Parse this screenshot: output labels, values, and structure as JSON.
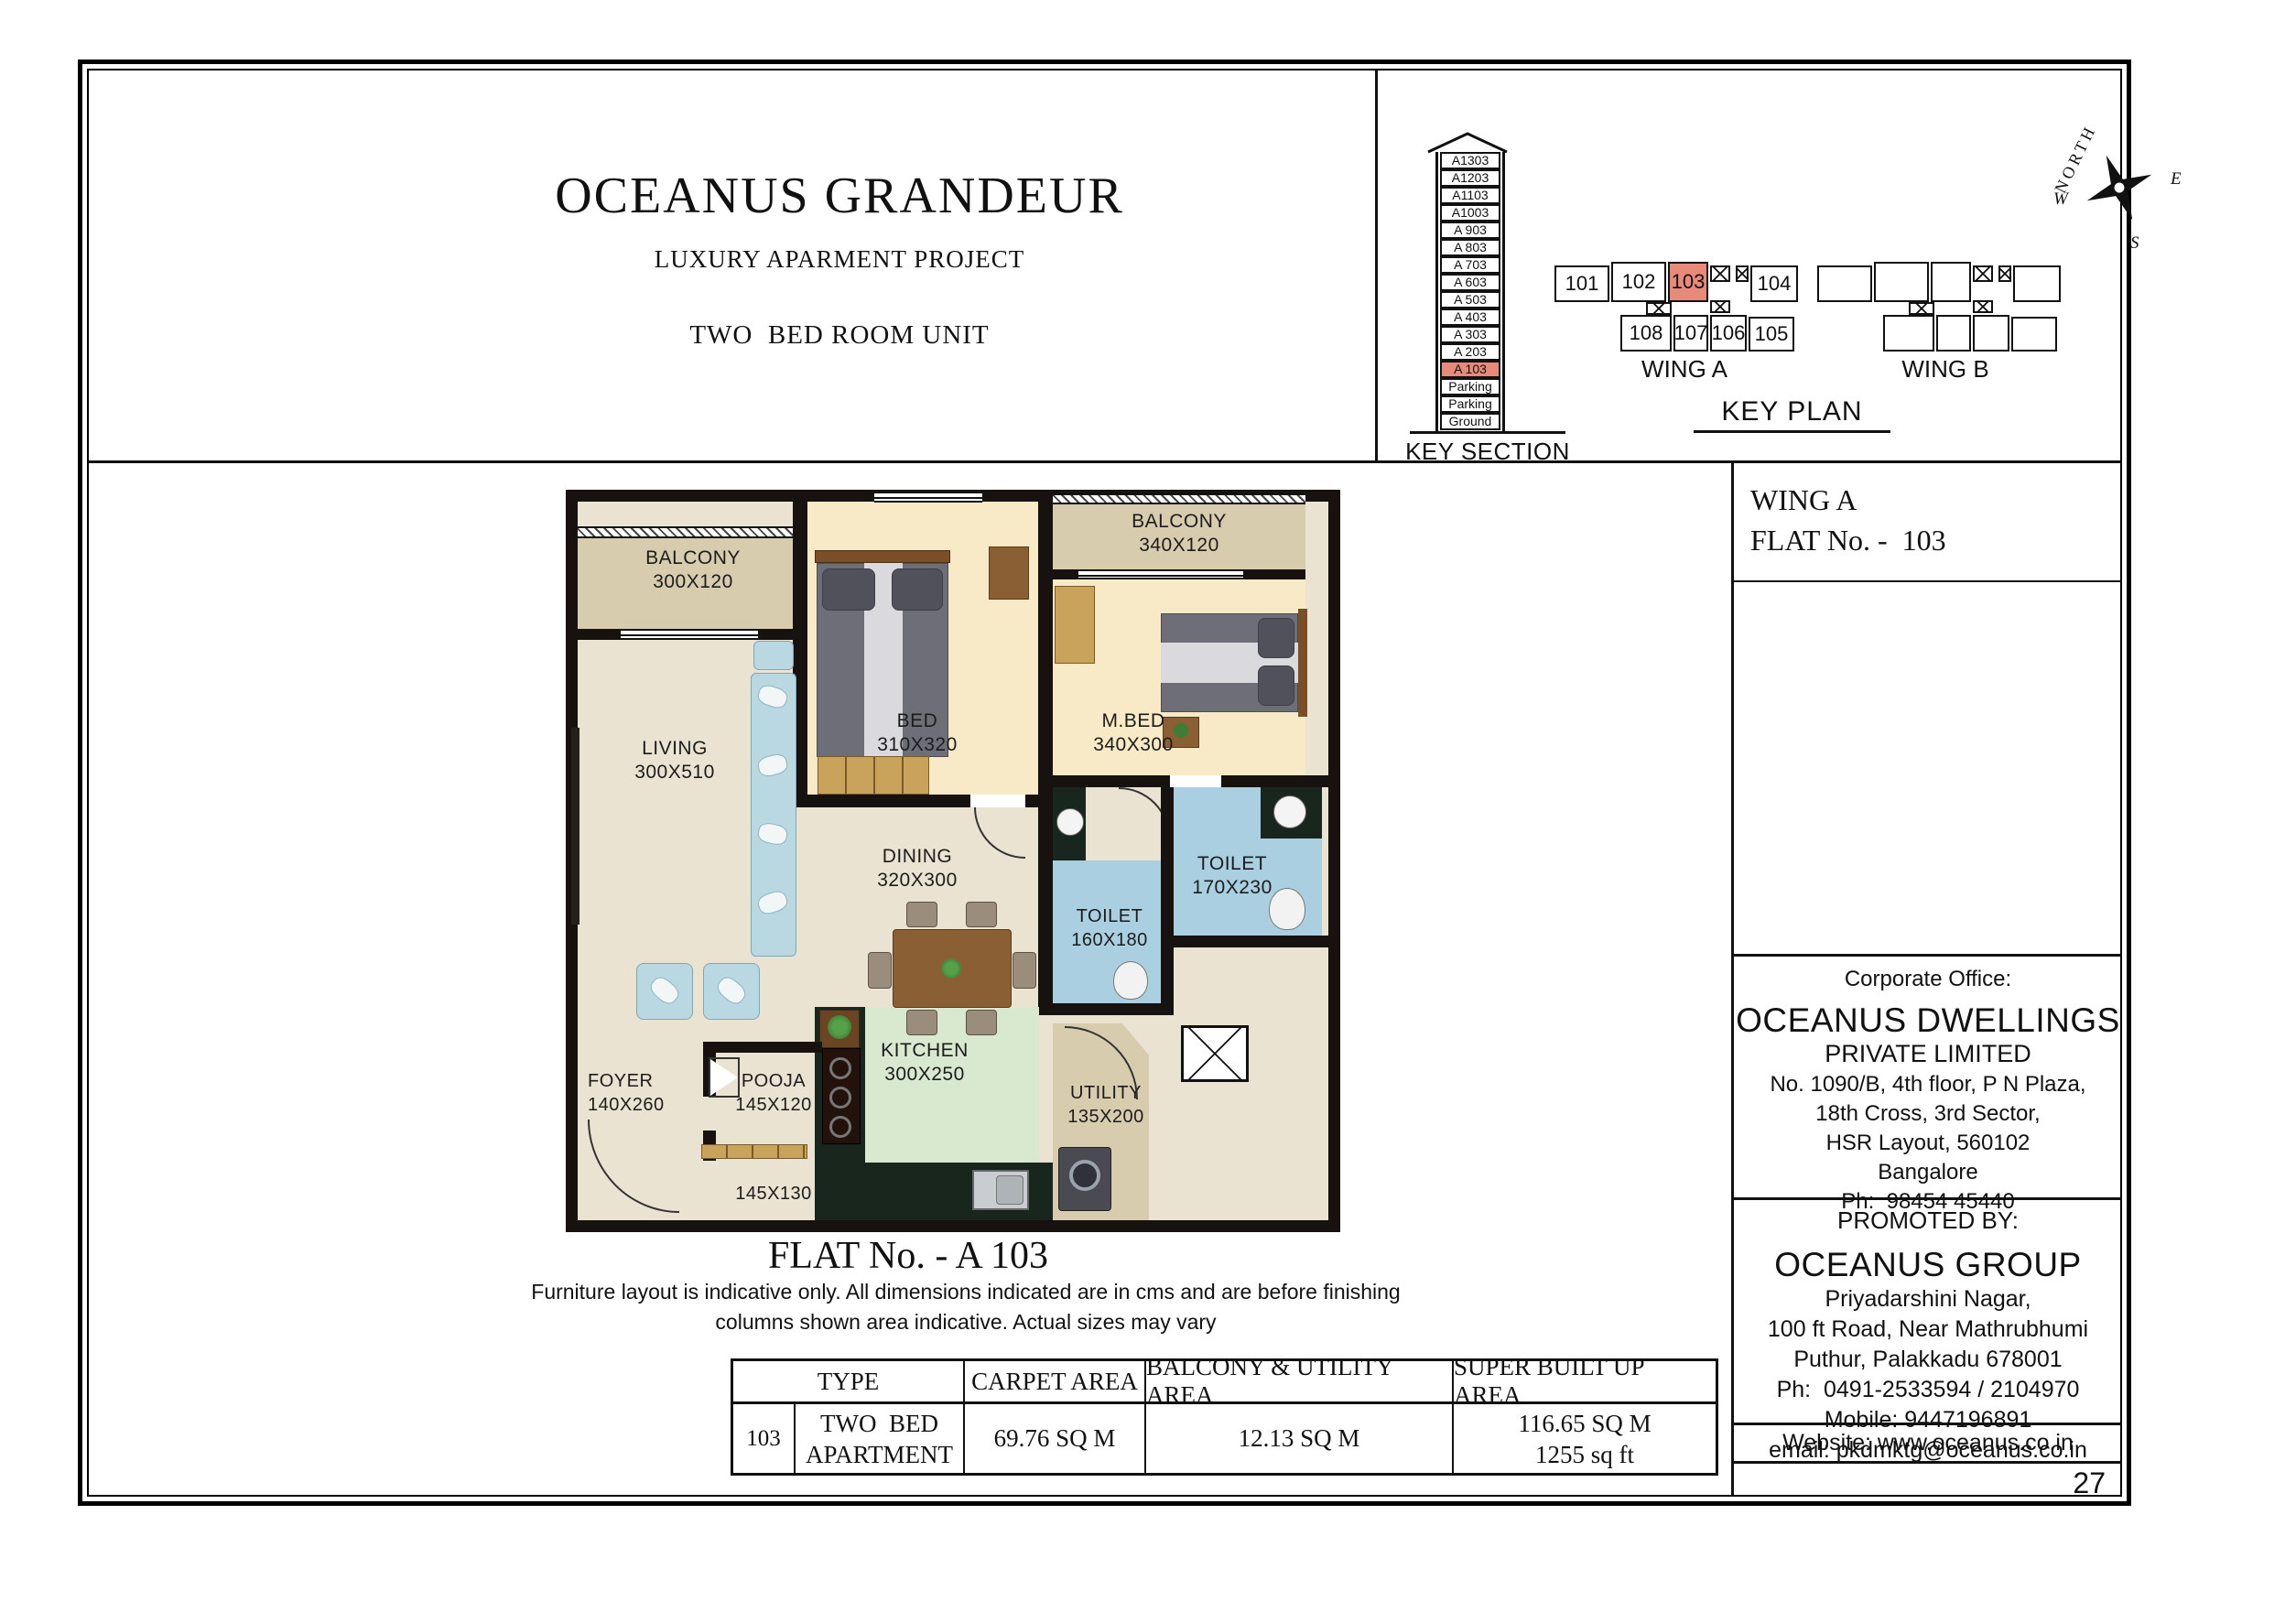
{
  "colors": {
    "highlight": "#e8897a",
    "toilet_blue": "#a9cfe0",
    "kitchen_green": "#d9e9cf",
    "balcony_beige": "#d8ccae",
    "bedroom_cream": "#f8eac6",
    "floor_cream": "#ebe3d1",
    "counter_dark": "#18261e",
    "wood": "#c9a25b",
    "wall": "#17120f",
    "sofa_blue": "#b9d8e1",
    "bed_gray": "#6e6e78"
  },
  "header": {
    "title": "OCEANUS GRANDEUR",
    "subtitle": "LUXURY APARMENT PROJECT",
    "unit_type": "TWO  BED ROOM UNIT"
  },
  "key_section": {
    "label": "KEY SECTION",
    "floors": [
      "A1303",
      "A1203",
      "A1103",
      "A1003",
      "A 903",
      "A 803",
      "A 703",
      "A 603",
      "A 503",
      "A 403",
      "A 303",
      "A 203",
      "A 103",
      "Parking",
      "Parking",
      "Ground"
    ],
    "highlighted_floor": "A 103"
  },
  "key_plan": {
    "label": "KEY PLAN",
    "wing_a": {
      "label": "WING A",
      "flats_top": [
        "101",
        "102",
        "103",
        "104"
      ],
      "flats_bottom": [
        "108",
        "107",
        "106",
        "105"
      ],
      "highlighted_flat": "103"
    },
    "wing_b": {
      "label": "WING B"
    }
  },
  "compass": {
    "north": "NORTH",
    "east": "E",
    "south": "S",
    "west": "W"
  },
  "sidebar": {
    "wing": "WING A",
    "flat_no": "FLAT No. -  103",
    "corporate_office": {
      "heading": "Corporate Office:",
      "company": "OCEANUS DWELLINGS",
      "company_suffix": "PRIVATE LIMITED",
      "address_lines": [
        "No. 1090/B, 4th floor, P N Plaza,",
        "18th Cross, 3rd Sector,",
        "HSR Layout, 560102",
        "Bangalore",
        "Ph:  98454 45440"
      ]
    },
    "promoted_by": {
      "heading": "PROMOTED BY:",
      "company": "OCEANUS GROUP",
      "address_lines": [
        "Priyadarshini Nagar,",
        "100 ft Road, Near Mathrubhumi",
        "Puthur, Palakkadu 678001",
        "Ph:  0491-2533594 / 2104970",
        "Mobile: 9447196891",
        "email: pkdmktg@oceanus.co.in"
      ]
    },
    "website": "Website: www.oceanus.co.in",
    "page_number": "27"
  },
  "plan": {
    "flat_title": "FLAT No. - A 103",
    "disclaimer_line1": "Furniture layout is indicative only. All dimensions indicated are in cms and are before finishing",
    "disclaimer_line2": "columns shown area indicative. Actual sizes may vary",
    "rooms": {
      "balcony_left": {
        "name": "BALCONY",
        "dim": "300X120"
      },
      "living": {
        "name": "LIVING",
        "dim": "300X510"
      },
      "bed": {
        "name": "BED",
        "dim": "310X320"
      },
      "balcony_right": {
        "name": "BALCONY",
        "dim": "340X120"
      },
      "mbed": {
        "name": "M.BED",
        "dim": "340X300"
      },
      "dining": {
        "name": "DINING",
        "dim": "320X300"
      },
      "toilet_right": {
        "name": "TOILET",
        "dim": "170X230"
      },
      "toilet_mid": {
        "name": "TOILET",
        "dim": "160X180"
      },
      "kitchen": {
        "name": "KITCHEN",
        "dim": "300X250"
      },
      "utility": {
        "name": "UTILITY",
        "dim": "135X200"
      },
      "foyer": {
        "name": "FOYER",
        "dim": "140X260"
      },
      "pooja": {
        "name": "POOJA",
        "dim": "145X120"
      },
      "passage": {
        "dim": "145X130"
      }
    }
  },
  "table": {
    "headers": [
      "TYPE",
      "CARPET AREA",
      "BALCONY & UTILITY AREA",
      "SUPER BUILT UP AREA"
    ],
    "row": {
      "flat": "103",
      "type_line1": "TWO  BED",
      "type_line2": "APARTMENT",
      "carpet_area": "69.76 SQ M",
      "balcony_utility_area": "12.13 SQ M",
      "super_built_up_line1": "116.65 SQ M",
      "super_built_up_line2": "1255 sq ft"
    }
  }
}
